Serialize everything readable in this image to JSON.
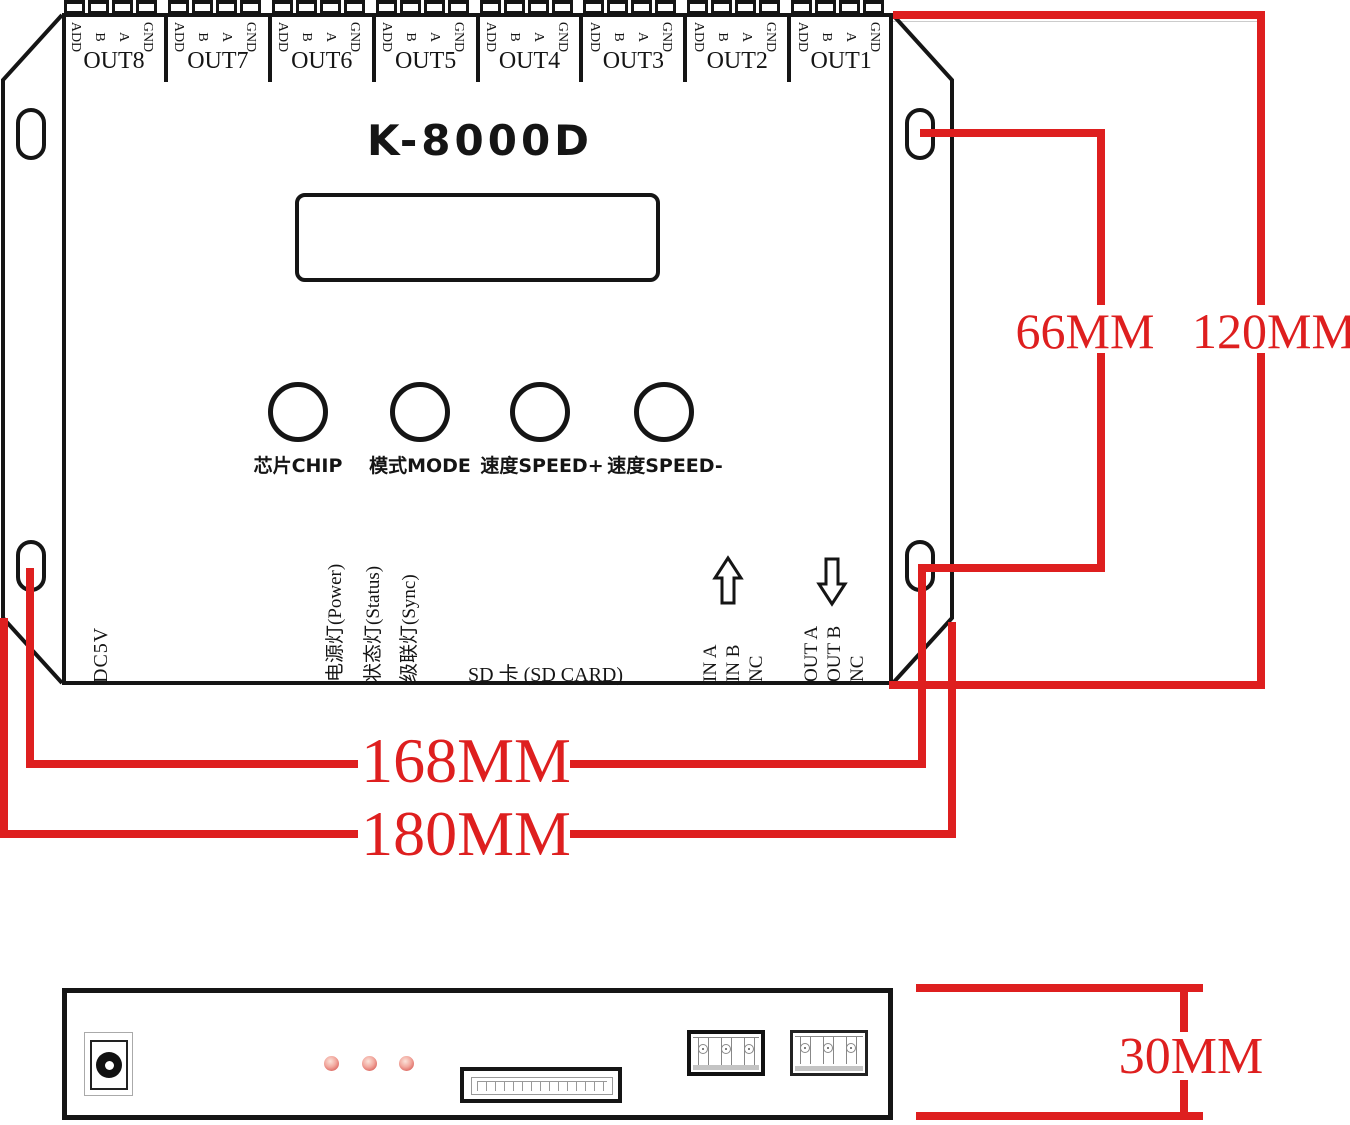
{
  "title": "K-8000D",
  "outputs": [
    {
      "label": "OUT8",
      "pins": [
        "ADD",
        "B",
        "A",
        "GND"
      ]
    },
    {
      "label": "OUT7",
      "pins": [
        "ADD",
        "B",
        "A",
        "GND"
      ]
    },
    {
      "label": "OUT6",
      "pins": [
        "ADD",
        "B",
        "A",
        "GND"
      ]
    },
    {
      "label": "OUT5",
      "pins": [
        "ADD",
        "B",
        "A",
        "GND"
      ]
    },
    {
      "label": "OUT4",
      "pins": [
        "ADD",
        "B",
        "A",
        "GND"
      ]
    },
    {
      "label": "OUT3",
      "pins": [
        "ADD",
        "B",
        "A",
        "GND"
      ]
    },
    {
      "label": "OUT2",
      "pins": [
        "ADD",
        "B",
        "A",
        "GND"
      ]
    },
    {
      "label": "OUT1",
      "pins": [
        "ADD",
        "B",
        "A",
        "GND"
      ]
    }
  ],
  "buttons": [
    "芯片CHIP",
    "模式MODE",
    "速度SPEED+",
    "速度SPEED-"
  ],
  "power_label": "DC5V",
  "indicators": [
    "电源灯(Power)",
    "状态灯(Status)",
    "级联灯(Sync)"
  ],
  "sd_label": "SD 卡 (SD CARD)",
  "input_pins": [
    "IN A",
    "IN B",
    "NC"
  ],
  "output_pins": [
    "OUT A",
    "OUT B",
    "NC"
  ],
  "dimensions": {
    "hole_vertical": "66MM",
    "body_vertical": "120MM",
    "hole_horizontal": "168MM",
    "body_horizontal": "180MM",
    "side_height": "30MM"
  },
  "colors": {
    "dimension": "#de1f1f",
    "line": "#151515",
    "led": "#dd6b64"
  }
}
